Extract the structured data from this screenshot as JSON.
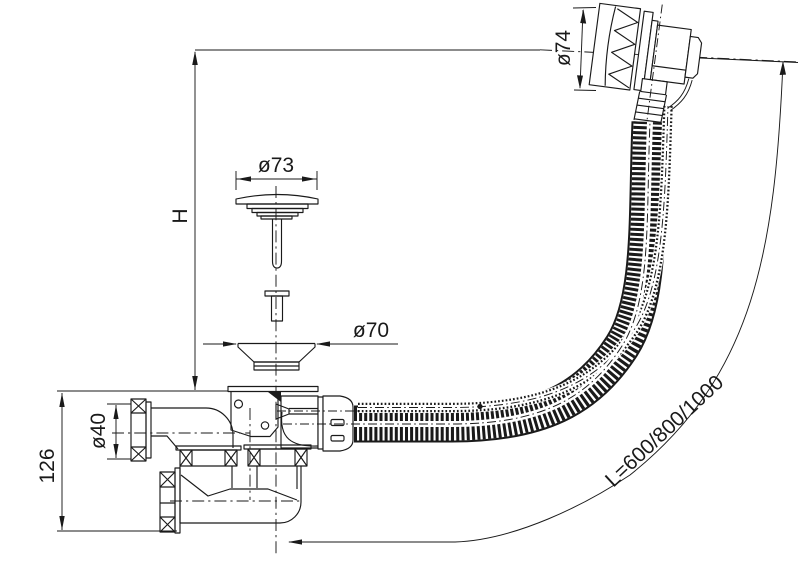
{
  "drawing": {
    "background": "#ffffff",
    "line_color": "#1a1a1a",
    "labels": {
      "installation_height": "H",
      "plug_diameter": "ø73",
      "overflow_diameter": "ø74",
      "flange_diameter": "ø70",
      "outlet_diameter": "ø40",
      "trap_height": "126",
      "hose_length": "L=600/800/1000"
    }
  }
}
